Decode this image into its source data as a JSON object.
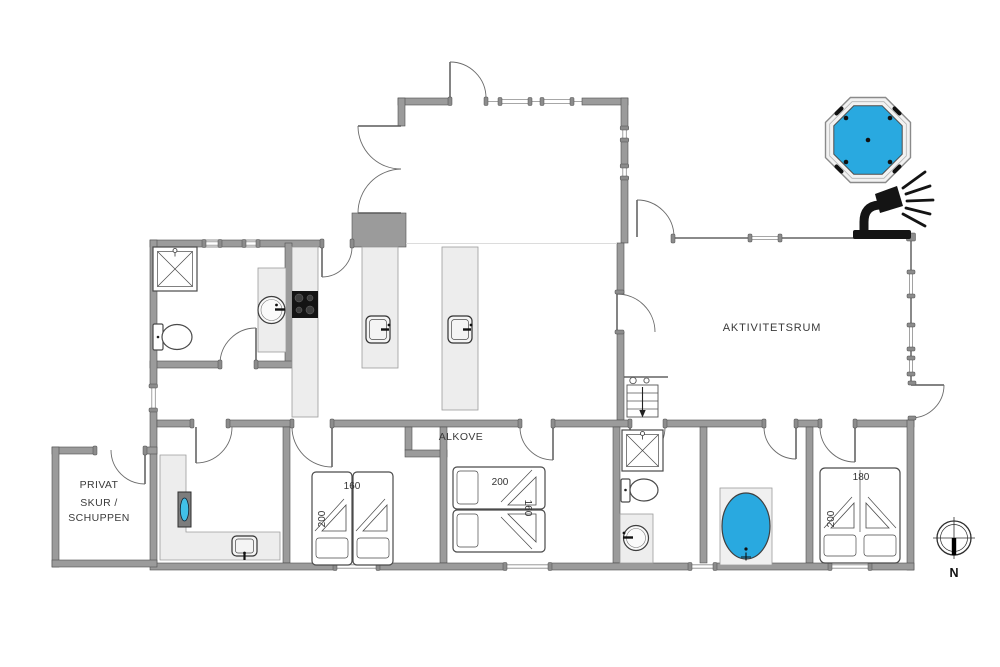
{
  "palette": {
    "background": "#ffffff",
    "wall": "#9b9b9b",
    "wall_edge": "#4f4f4f",
    "annex_wall": "#8a8a8a",
    "counter": "#ededed",
    "door_arc": "#6b6b6b",
    "water": "#29a9e0",
    "tv_screen": "#41c0e8",
    "icon_black": "#141414",
    "text": "#3a3a3a"
  },
  "rooms": {
    "activity_room": "AKTIVITETSRUM",
    "alcove_label": "ALKOVE",
    "shed_line1": "PRIVAT",
    "shed_line2": "SKUR /",
    "shed_line3": "SCHUPPEN"
  },
  "beds": {
    "west_bedroom": {
      "width_label": "160",
      "length_label": "200"
    },
    "alcove_bed": {
      "length_label": "200",
      "width_label": "160"
    },
    "east_bedroom": {
      "width_label": "180",
      "length_label": "200"
    }
  },
  "compass": {
    "north_label": "N"
  },
  "icons": {
    "hot_tub": "hot-tub-icon",
    "outdoor_shower": "outdoor-shower-icon",
    "compass_rose": "compass-rose-icon",
    "shower_cabin": "shower-cabin-icon",
    "toilet": "toilet-icon",
    "washbasin": "washbasin-icon",
    "sink": "sink-icon",
    "cooktop": "cooktop-icon",
    "bathtub": "bathtub-icon",
    "tv": "tv-icon",
    "stairs": "stairs-down-icon"
  }
}
